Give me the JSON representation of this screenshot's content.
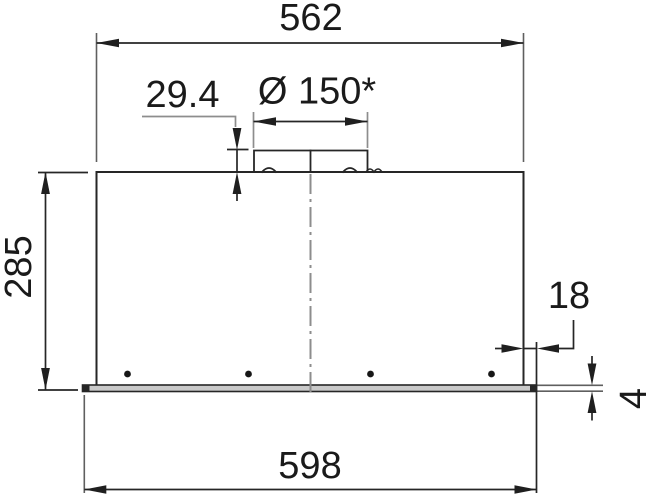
{
  "drawing": {
    "view": "front-dimension-drawing",
    "units": "mm",
    "dims": {
      "overall_width": {
        "label": "562"
      },
      "collar_height": {
        "label": "29.4"
      },
      "duct_diameter": {
        "label": "Ø 150*"
      },
      "height": {
        "label": "285"
      },
      "rim_offset": {
        "label": "18"
      },
      "rim_thickness": {
        "label": "4"
      },
      "panel_width": {
        "label": "598"
      }
    },
    "colors": {
      "line": "#262626",
      "extension_line": "#5f5f5f",
      "leader_line": "#8d8d8d",
      "centerline": "#8d8d8d",
      "panel_fill": "#c9c9c9",
      "text": "#1a1a1a",
      "background": "#ffffff"
    }
  }
}
